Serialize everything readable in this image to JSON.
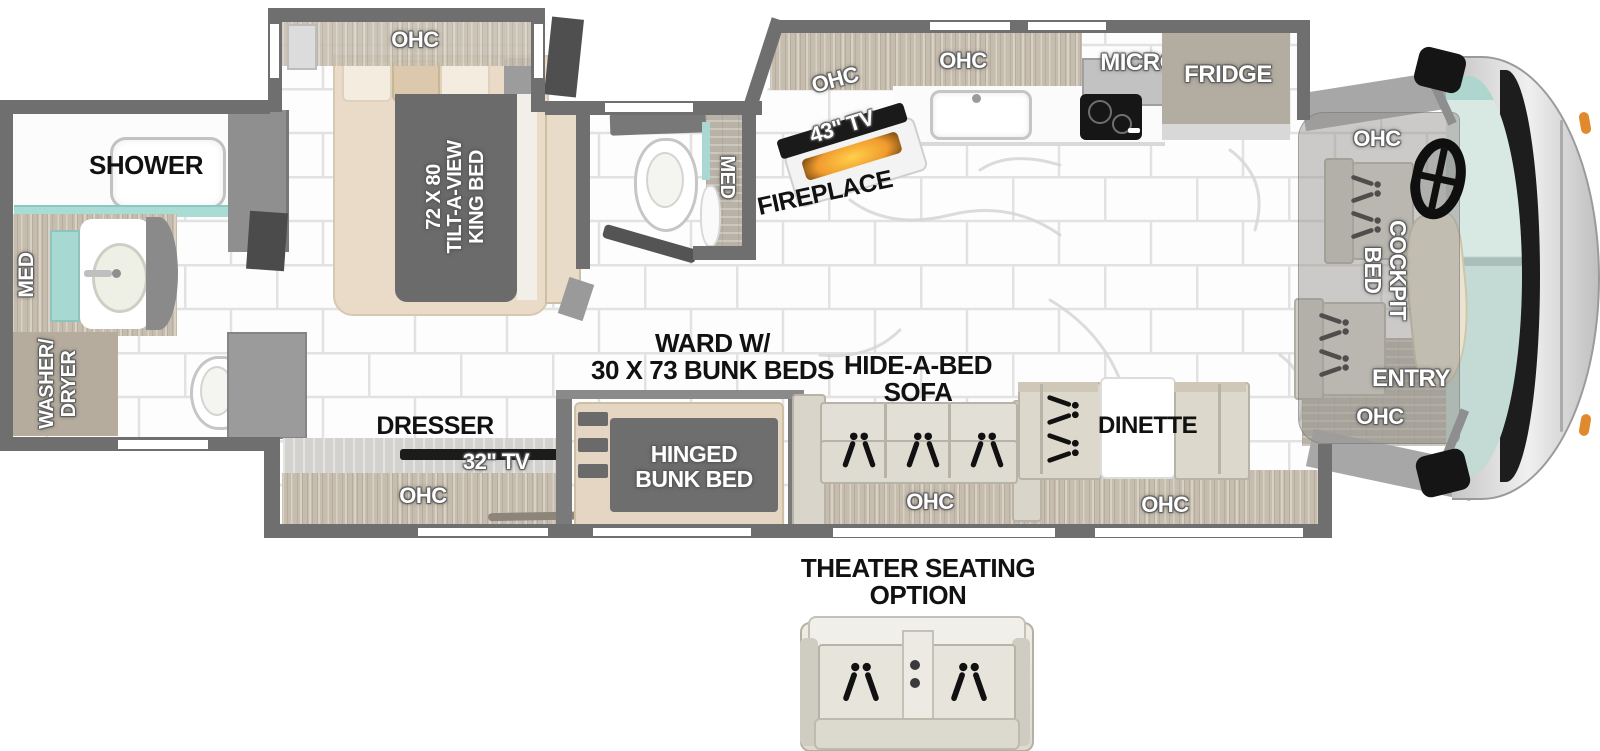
{
  "page": {
    "type": "RV motorhome floorplan diagram",
    "background": "#ffffff"
  },
  "colors": {
    "wall": "#6f6f6f",
    "wood": "#c6bdae",
    "tile": "#fdfdfd",
    "grout": "#e2e2e2",
    "accent_teal": "#aad8d2",
    "fireplace_glow": "#f09b2e",
    "windshield": "#d5e7e0",
    "blanket_gray": "#6b6b6b",
    "label_dark": "#111111",
    "label_light": "#ffffff"
  },
  "bedroom": {
    "ohc": "OHC",
    "bed_line1": "72 X 80",
    "bed_line2": "TILT-A-VIEW",
    "bed_line3": "KING BED"
  },
  "rear_bath": {
    "shower": "SHOWER",
    "med": "MED",
    "washer_line1": "WASHER/",
    "washer_line2": "DRYER"
  },
  "mid_bath": {
    "med": "MED"
  },
  "kitchen": {
    "ohc_left": "OHC",
    "ohc_center": "OHC",
    "micro": "MICRO",
    "fridge": "FRIDGE",
    "tv": "43\" TV",
    "fireplace": "FIREPLACE"
  },
  "living": {
    "ward_line1": "WARD W/",
    "ward_line2": "30 X 73 BUNK BEDS",
    "bunk_line1": "HINGED",
    "bunk_line2": "BUNK BED",
    "sofa_line1": "HIDE-A-BED",
    "sofa_line2": "SOFA",
    "sofa_ohc": "OHC",
    "dinette": "DINETTE",
    "dinette_ohc": "OHC",
    "dresser": "DRESSER",
    "dresser_tv": "32\" TV",
    "dresser_ohc": "OHC"
  },
  "cockpit": {
    "ohc_top": "OHC",
    "bed_line1": "COCKPIT",
    "bed_line2": "BED",
    "entry": "ENTRY",
    "ohc_bottom": "OHC"
  },
  "theater": {
    "line1": "THEATER SEATING",
    "line2": "OPTION"
  }
}
